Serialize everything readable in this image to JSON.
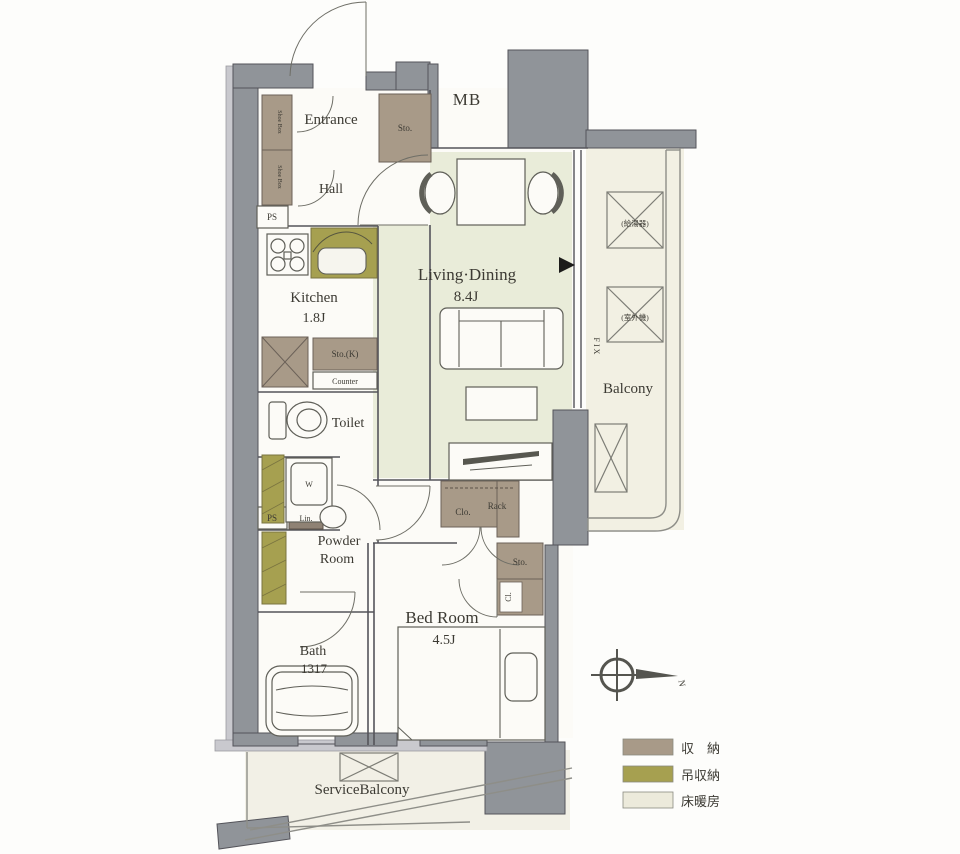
{
  "plan": {
    "rooms": {
      "entrance": "Entrance",
      "hall": "Hall",
      "mb": "MB",
      "kitchen": "Kitchen",
      "kitchen_size": "1.8J",
      "living": "Living·Dining",
      "living_size": "8.4J",
      "balcony": "Balcony",
      "toilet": "Toilet",
      "powder1": "Powder",
      "powder2": "Room",
      "bath": "Bath",
      "bath_size": "1317",
      "bedroom": "Bed Room",
      "bedroom_size": "4.5J",
      "service_balcony": "ServiceBalcony"
    },
    "fixtures": {
      "sto": "Sto.",
      "shoe_box": "Shoe Box",
      "ps": "PS",
      "sto_k": "Sto.(K)",
      "counter": "Counter",
      "washer": "W",
      "linen": "Lin.",
      "closet": "Clo.",
      "rack": "Rack",
      "sto2": "Sto.",
      "cl": "Cl.",
      "fix": "FIX",
      "water_heater": "(給湯器)",
      "ac_unit": "(室外機)"
    },
    "compass": {
      "north": "N"
    },
    "legend": [
      {
        "label": "収　納",
        "color": "#a89a88"
      },
      {
        "label": "吊収納",
        "color": "#a6a050"
      },
      {
        "label": "床暖房",
        "color": "#eceadb"
      }
    ]
  }
}
